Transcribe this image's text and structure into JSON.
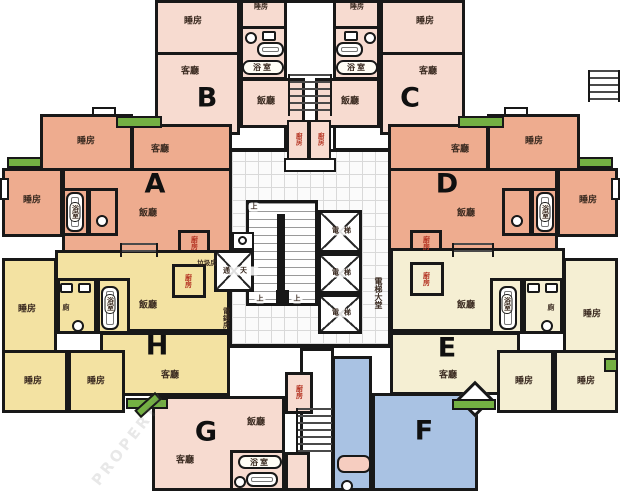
{
  "plan": {
    "units": {
      "a": "A",
      "b": "B",
      "c": "C",
      "d": "D",
      "e": "E",
      "f": "F",
      "g": "G",
      "h": "H"
    },
    "rooms": {
      "bedroom": "睡房",
      "living": "客廳",
      "dining": "飯廳",
      "bath": "浴室",
      "kitchen": "廚房",
      "toilet": "廁",
      "refuse": "垃圾房",
      "meter": "電錶房",
      "lightwell": "通天",
      "elevator": "電梯",
      "elevator_lobby": "電梯大堂",
      "up": "上"
    },
    "watermark": "PROPERTY",
    "colors": {
      "unit_a_d": "#eeac8f",
      "unit_b_c_g": "#f7dbd0",
      "unit_e": "#f5efd3",
      "unit_h": "#f3e2a2",
      "unit_f": "#a9c2e3",
      "balcony": "#74b043",
      "wall": "#181818"
    }
  }
}
